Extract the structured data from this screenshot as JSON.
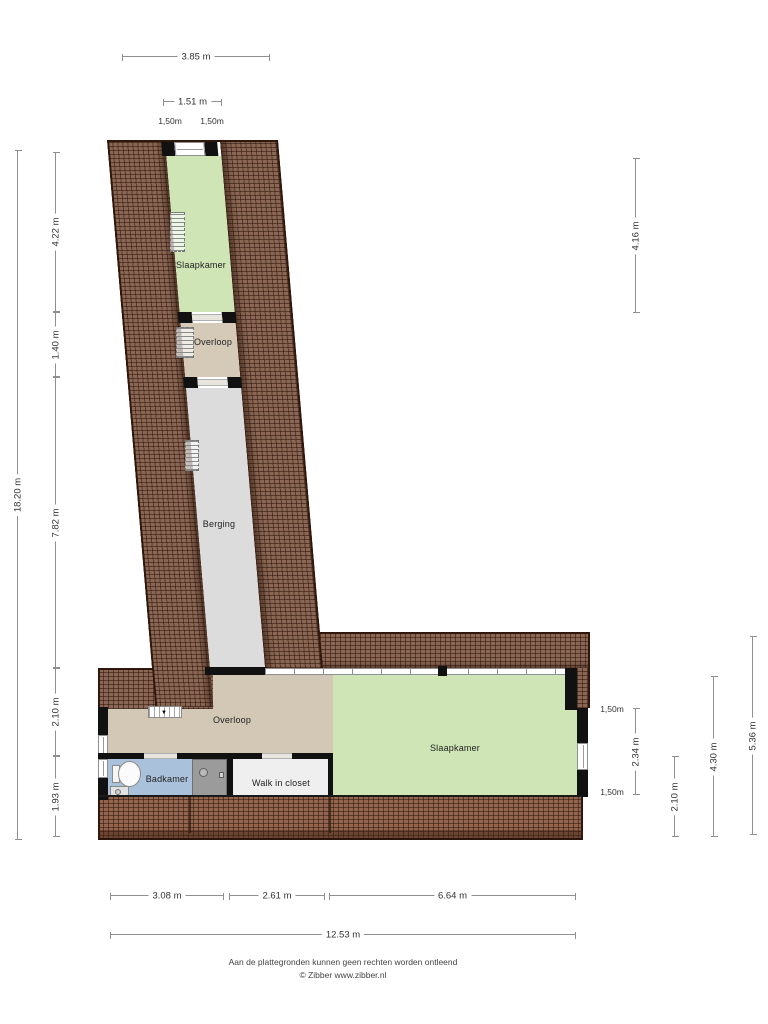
{
  "rooms": {
    "slaapkamer_top": "Slaapkamer",
    "overloop_top": "Overloop",
    "berging": "Berging",
    "overloop_bottom": "Overloop",
    "badkamer": "Badkamer",
    "walk_in_closet": "Walk in closet",
    "slaapkamer_bottom": "Slaapkamer"
  },
  "dims": {
    "top": [
      "3.85 m",
      "1.51 m"
    ],
    "top_small": [
      "1,50m",
      "1,50m"
    ],
    "left": [
      "18.20 m",
      "4.22 m",
      "1.40 m",
      "7.82 m",
      "2.10 m",
      "1.93 m"
    ],
    "right": [
      "4.16 m",
      "2.34 m",
      "2.10 m",
      "4.30 m",
      "5.36 m"
    ],
    "right_small": [
      "1,50m",
      "1,50m"
    ],
    "bottom": [
      "3.08 m",
      "2.61 m",
      "6.64 m",
      "12.53 m"
    ]
  },
  "footer": {
    "disclaimer": "Aan de plattegronden kunnen geen rechten worden ontleend",
    "credit": "© Zibber www.zibber.nl"
  },
  "colors": {
    "roof": "#8a6754",
    "roof_dark_edge": "#2f170c",
    "bedroom_green": "#cfe5b6",
    "landing_tan": "#d3c7b6",
    "storage_gray": "#dcdcdc",
    "bathroom_blue": "#a9c1da",
    "closet_white": "#efefef",
    "wall_black": "#111111"
  }
}
